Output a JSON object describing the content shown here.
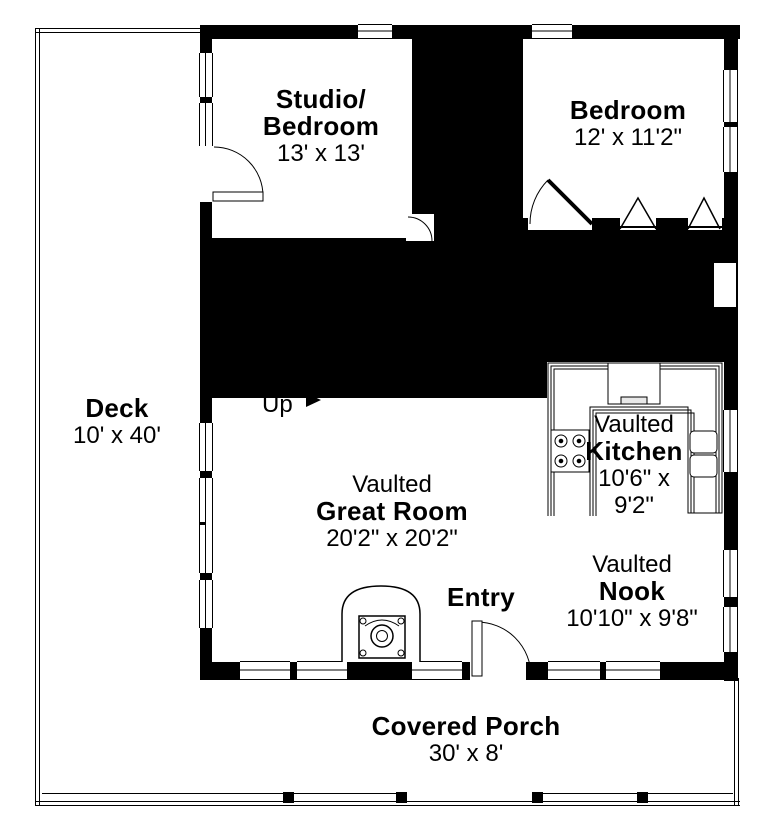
{
  "colors": {
    "wall": "#000000",
    "floor": "#ffffff",
    "line": "#000000"
  },
  "rooms": {
    "studio": {
      "name_line1": "Studio/",
      "name_line2": "Bedroom",
      "dims": "13' x 13'"
    },
    "bedroom": {
      "name": "Bedroom",
      "dims": "12' x 11'2\""
    },
    "great_room": {
      "qualifier": "Vaulted",
      "name": "Great Room",
      "dims": "20'2\" x 20'2\""
    },
    "kitchen": {
      "qualifier": "Vaulted",
      "name": "Kitchen",
      "dims_line1": "10'6\" x",
      "dims_line2": "9'2\""
    },
    "nook": {
      "qualifier": "Vaulted",
      "name": "Nook",
      "dims": "10'10\" x 9'8\""
    },
    "deck": {
      "name": "Deck",
      "dims": "10' x 40'"
    },
    "covered_porch": {
      "name": "Covered Porch",
      "dims": "30' x 8'"
    }
  },
  "labels": {
    "entry": "Entry",
    "stairs_up": "Up"
  },
  "fixtures": [
    "wood-stove",
    "range-oven",
    "cooktop-4-burner",
    "double-sink",
    "bifold-closet-doors",
    "stair-up-arrow",
    "porch-railing-posts"
  ]
}
